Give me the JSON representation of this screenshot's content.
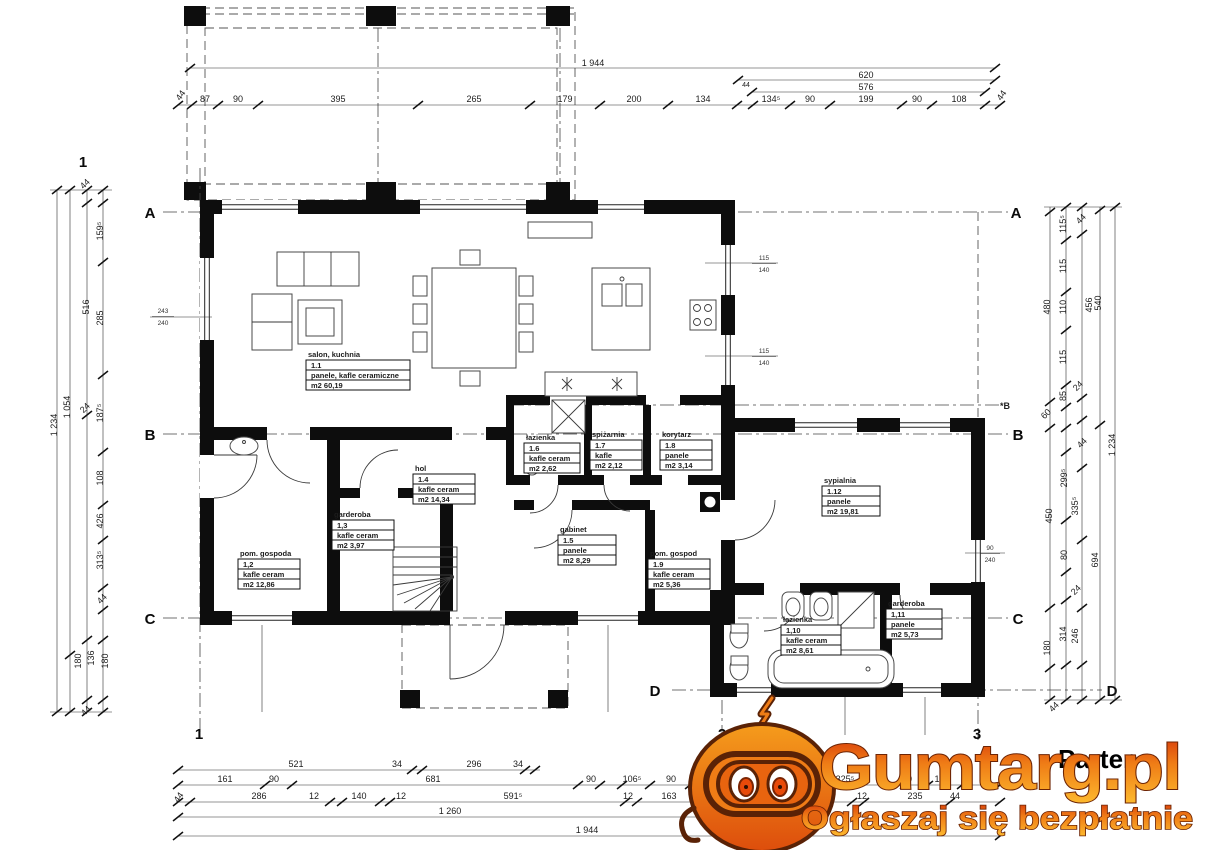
{
  "plan": {
    "title": "Parter",
    "grid": {
      "a": "A",
      "b": "B",
      "c": "C",
      "d": "D",
      "n1": "1",
      "n2": "2",
      "n3": "3",
      "b_aux": "*B"
    },
    "rooms": [
      {
        "name": "salon, kuchnia",
        "number": "1.1",
        "floor": "panele, kafle ceramiczne",
        "area": "m2 60,19"
      },
      {
        "name": "pom. gospoda",
        "number": "1,2",
        "floor": "kafle ceram",
        "area": "m2 12,86"
      },
      {
        "name": "garderoba",
        "number": "1,3",
        "floor": "kafle ceram",
        "area": "m2 3,97"
      },
      {
        "name": "hol",
        "number": "1.4",
        "floor": "kafle ceram",
        "area": "m2 14,34"
      },
      {
        "name": "gabinet",
        "number": "1.5",
        "floor": "panele",
        "area": "m2 8,29"
      },
      {
        "name": "łazienka",
        "number": "1.6",
        "floor": "kafle ceram",
        "area": "m2 2,62"
      },
      {
        "name": "spiżarnia",
        "number": "1.7",
        "floor": "kafle",
        "area": "m2 2,12"
      },
      {
        "name": "korytarz",
        "number": "1.8",
        "floor": "panele",
        "area": "m2 3,14"
      },
      {
        "name": "pom. gospod",
        "number": "1.9",
        "floor": "kafle ceram",
        "area": "m2 5,36"
      },
      {
        "name": "łazienka",
        "number": "1,10",
        "floor": "kafle ceram",
        "area": "m2 8,61"
      },
      {
        "name": "garderoba",
        "number": "1,11",
        "floor": "panele",
        "area": "m2 5,73"
      },
      {
        "name": "sypialnia",
        "number": "1.12",
        "floor": "panele",
        "area": "m2 19,81"
      }
    ],
    "dims": {
      "top": {
        "total": "1 944",
        "sub1": "620",
        "sub2": "576",
        "segments": [
          "44",
          "87",
          "90",
          "395",
          "265",
          "179",
          "200",
          "134",
          "44",
          "134⁵",
          "90",
          "199",
          "90",
          "108",
          "44"
        ]
      },
      "bottom": {
        "row1": [
          "521",
          "34",
          "296",
          "34"
        ],
        "row2": [
          "161",
          "90",
          "681",
          "90",
          "106⁵",
          "90",
          "41⁵",
          "87",
          "90",
          "325⁵",
          "90",
          "121"
        ],
        "row3": [
          "44",
          "286",
          "12",
          "140",
          "12",
          "591⁵",
          "12",
          "163",
          "12",
          "235",
          "44"
        ],
        "row4": "1 260",
        "total": "1 944"
      },
      "left": {
        "total": "1 234",
        "col2": [
          "1 054",
          "180"
        ],
        "col3": [
          "44",
          "516",
          "24",
          "136",
          "44"
        ],
        "col4": [
          "159⁵",
          "285",
          "187⁵",
          "108",
          "426",
          "313⁵",
          "44",
          "180"
        ]
      },
      "right": {
        "col1": [
          "480",
          "60",
          "450",
          "180"
        ],
        "col2": [
          "115⁵",
          "115",
          "110",
          "115",
          "85",
          "299⁵",
          "80",
          "314"
        ],
        "col3": [
          "44",
          "456",
          "24",
          "44",
          "335⁵",
          "24",
          "246",
          "44"
        ],
        "col4": [
          "540",
          "694"
        ],
        "total": "1 234"
      }
    },
    "window_marks": [
      {
        "t": "115",
        "b": "140"
      },
      {
        "t": "115",
        "b": "140"
      },
      {
        "t": "243",
        "b": "240"
      },
      {
        "t": "90",
        "b": "240"
      }
    ]
  },
  "watermark": {
    "brand": "Gumtarg.pl",
    "tagline": "Ogłaszaj się bezpłatnie",
    "colors": {
      "gradient_top": "#d43109",
      "gradient_mid": "#ef7c16",
      "gradient_bottom": "#fdb92e",
      "outline": "#6d2404",
      "body": "#e8640f"
    }
  }
}
